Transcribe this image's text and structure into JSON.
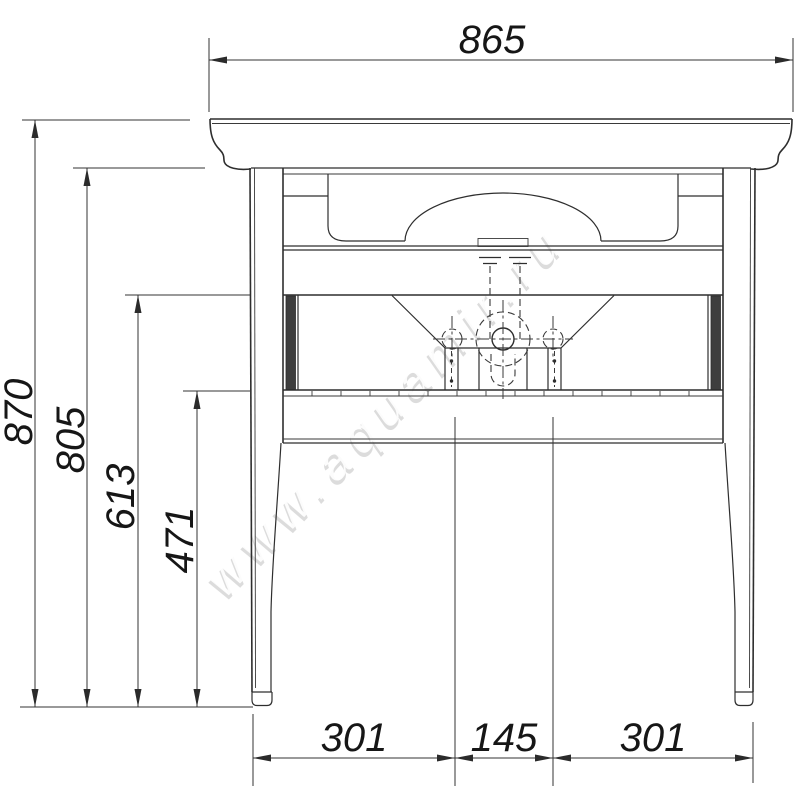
{
  "drawing": {
    "description": "Front-view technical drawing of a washbasin console with legs and dimension lines",
    "watermark": "www.aquamir.ru",
    "dims": {
      "width_top": "865",
      "height_total": "870",
      "height_under_countertop": "805",
      "height_mid_rail": "613",
      "height_lower_rail": "471",
      "bottom_left_span": "301",
      "bottom_center_span": "145",
      "bottom_right_span": "301"
    },
    "colors": {
      "line": "#2e2e2e",
      "dimension": "#333333",
      "text": "#161616",
      "watermark_gray": "#b3b3b3",
      "watermark_white": "#ffffff",
      "background": "#ffffff"
    }
  }
}
